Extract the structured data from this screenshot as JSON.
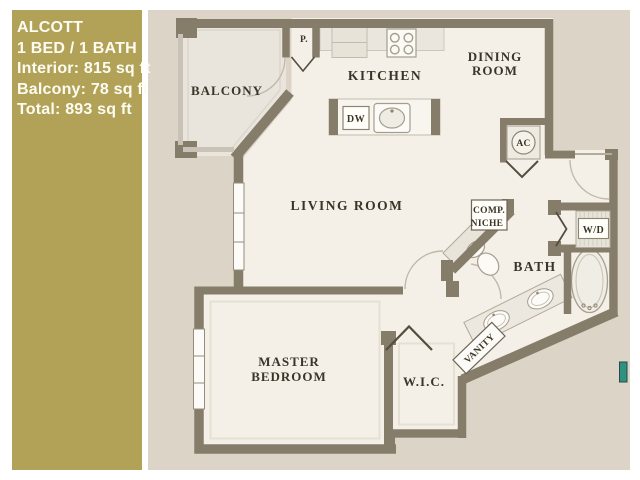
{
  "info_panel": {
    "title": "ALCOTT",
    "subtitle": "1 BED / 1 BATH",
    "interior": "Interior: 815 sq ft",
    "balcony": "Balcony: 78 sq ft",
    "total": "Total: 893 sq ft"
  },
  "floor_plan": {
    "rooms": {
      "balcony": "BALCONY",
      "kitchen": "KITCHEN",
      "dining_line1": "DINING",
      "dining_line2": "ROOM",
      "living": "LIVING ROOM",
      "master_line1": "MASTER",
      "master_line2": "BEDROOM",
      "wic": "W.I.C.",
      "bath": "BATH"
    },
    "fixtures": {
      "pantry": "P.",
      "dishwasher": "DW",
      "ac": "AC",
      "washer_dryer": "W/D",
      "comp_niche_line1": "COMP.",
      "comp_niche_line2": "NICHE",
      "vanity": "VANITY"
    },
    "colors": {
      "panel_gold": "#b2a258",
      "background": "#dcd4c6",
      "floor": "#f4f0e8",
      "balcony_floor": "#e9e5dd",
      "wall": "#867c6a",
      "label_text": "#3b3528",
      "marker_teal": "#2f9180"
    }
  }
}
